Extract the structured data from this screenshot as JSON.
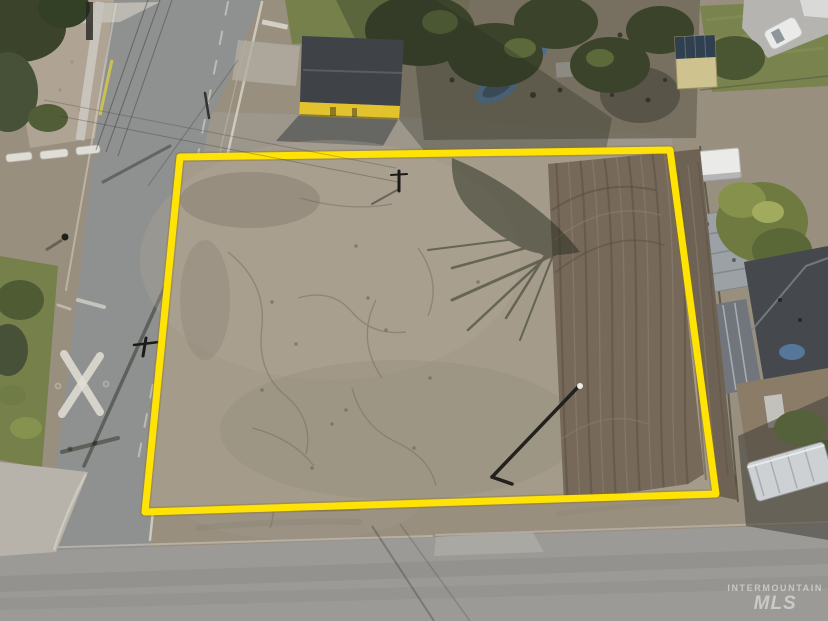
{
  "meta": {
    "image_type": "aerial drone photograph",
    "subject": "vacant dirt land parcel outlined in yellow for a real-estate listing, bordered by two streets with houses, yards and trees around it"
  },
  "watermark": {
    "line1": "INTERMOUNTAIN",
    "line2": "MLS"
  },
  "boundary": {
    "points": "180,157 670,150 716,494 145,512",
    "color": "#FFE206",
    "edge_color": "#8A6E00",
    "stroke_width": 7
  },
  "palette": {
    "outside_dirt": "#998F7F",
    "lot_dirt": "#A49B8B",
    "tilled_soil": "#77695A",
    "tilled_soil_outside": "#6E6254",
    "road_left": "#8F9090",
    "road_bottom": "#9B9A97",
    "sidewalk": "#B7B3AA",
    "gravel": "#AFA494",
    "grass": "#75804B",
    "tree_dark": "#3B442B",
    "tree_light": "#86924B",
    "roof_dark": "#45494D",
    "building_roof": "#3F4347",
    "building_yellow": "#E2C22D",
    "container_tan": "#CEC28F",
    "solar_panel": "#31404F",
    "vehicle_white": "#EAEBE8",
    "trailer_gray": "#9CA1A5",
    "rv_silver": "#CDD1D3",
    "tarp_blue": "#56779B",
    "marking_white": "#E2DFD5",
    "shadow_green": "#262C1D",
    "watermark_color": "rgba(240,240,236,0.55)"
  },
  "objects": [
    "vacant dirt lot parcel",
    "yellow property boundary outline",
    "tilled soil strip",
    "tree shadow on lot",
    "irrigation pipe",
    "utility pole in lot",
    "street on left",
    "street on bottom",
    "street intersection",
    "railroad crossing X pavement marking",
    "white lane markings",
    "sidewalk",
    "gravel shoulder",
    "parking bumpers",
    "fire hydrant",
    "grass shoulder",
    "trees",
    "yellow-walled outbuilding with dark roof",
    "storage yard with tarps and boat",
    "tan shipping container with solar panels",
    "white car on driveway",
    "white box truck",
    "mobile home trailer",
    "dark gray house roof",
    "blue tarp on roof",
    "silver RV trailer",
    "power line shadows",
    "Intermountain MLS watermark"
  ]
}
